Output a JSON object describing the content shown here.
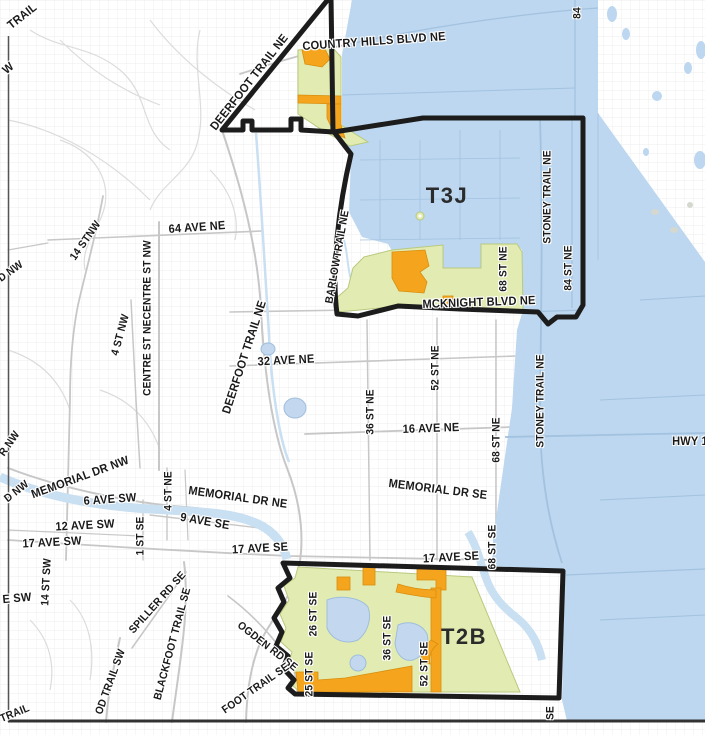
{
  "map": {
    "title": "Calgary zone map T3J / T2B",
    "zones": {
      "north_zone": "T3J",
      "south_zone": "T2B"
    },
    "colors": {
      "blue_region": "#BCD7EF",
      "zone_green": "#E2ECB2",
      "zone_green_edge": "#B9C97E",
      "orange": "#F5A51D",
      "orange_edge": "#D78E10",
      "boundary": "#1C1C1C",
      "river": "#C9DFF2",
      "pond": "#C3D8EE",
      "pond_edge": "#9FBEDC",
      "road_gray": "#C7C7C7",
      "road_light": "#DCDCDC",
      "road_blue": "#A3C2E0",
      "grid": "#E9E9E9",
      "label": "#1A1A1A",
      "frame": "#333333"
    },
    "labels": [
      {
        "t": "TRAIL",
        "x": 22,
        "y": 16,
        "r": -38,
        "s": 12
      },
      {
        "t": "W",
        "x": 8,
        "y": 68,
        "r": -40,
        "s": 12
      },
      {
        "t": "COUNTRY HILLS BLVD NE",
        "x": 374,
        "y": 41,
        "r": -4,
        "s": 12
      },
      {
        "t": "DEERFOOT TRAIL NE",
        "x": 249,
        "y": 82,
        "r": -52,
        "s": 12
      },
      {
        "t": "84",
        "x": 578,
        "y": 13,
        "r": -90,
        "s": 11
      },
      {
        "t": "T3J",
        "x": 447,
        "y": 196,
        "r": 0,
        "s": 22,
        "z": true
      },
      {
        "t": "STONEY TRAIL NE",
        "x": 548,
        "y": 197,
        "r": -90,
        "s": 11
      },
      {
        "t": "84 ST NE",
        "x": 569,
        "y": 268,
        "r": -90,
        "s": 11
      },
      {
        "t": "68 ST NE",
        "x": 504,
        "y": 269,
        "r": -90,
        "s": 11
      },
      {
        "t": "MCKNIGHT BLVD NE",
        "x": 479,
        "y": 302,
        "r": -2,
        "s": 12
      },
      {
        "t": "BARLOWTRAIL NE",
        "x": 338,
        "y": 257,
        "r": -80,
        "s": 11
      },
      {
        "t": "64 AVE NE",
        "x": 197,
        "y": 227,
        "r": -4,
        "s": 12
      },
      {
        "t": "14 STNW",
        "x": 86,
        "y": 241,
        "r": -55,
        "s": 11
      },
      {
        "t": "CENTRE ST NECENTRE ST NW",
        "x": 148,
        "y": 318,
        "r": -90,
        "s": 11
      },
      {
        "t": "4 ST NW",
        "x": 121,
        "y": 335,
        "r": -75,
        "s": 11
      },
      {
        "t": "DEERFOOT TRAIL NE",
        "x": 244,
        "y": 357,
        "r": -72,
        "s": 12
      },
      {
        "t": "32 AVE NE",
        "x": 286,
        "y": 360,
        "r": -3,
        "s": 12
      },
      {
        "t": "52 ST NE",
        "x": 436,
        "y": 368,
        "r": -90,
        "s": 11
      },
      {
        "t": "36 ST NE",
        "x": 371,
        "y": 412,
        "r": -90,
        "s": 11
      },
      {
        "t": "16 AVE NE",
        "x": 431,
        "y": 428,
        "r": -2,
        "s": 12
      },
      {
        "t": "68 ST NE",
        "x": 497,
        "y": 440,
        "r": -90,
        "s": 11
      },
      {
        "t": "STONEY TRAIL NE",
        "x": 541,
        "y": 401,
        "r": -90,
        "s": 11
      },
      {
        "t": "HWY 1",
        "x": 690,
        "y": 441,
        "r": 0,
        "s": 12
      },
      {
        "t": "MEMORIAL DR NW",
        "x": 80,
        "y": 477,
        "r": -20,
        "s": 12
      },
      {
        "t": "MEMORIAL DR NE",
        "x": 238,
        "y": 497,
        "r": 8,
        "s": 12
      },
      {
        "t": "6 AVE SW",
        "x": 110,
        "y": 499,
        "r": -4,
        "s": 12
      },
      {
        "t": "4 ST NE",
        "x": 169,
        "y": 491,
        "r": -90,
        "s": 11
      },
      {
        "t": "9 AVE SE",
        "x": 205,
        "y": 521,
        "r": 10,
        "s": 12
      },
      {
        "t": "12 AVE SW",
        "x": 85,
        "y": 525,
        "r": -3,
        "s": 12
      },
      {
        "t": "17 AVE SW",
        "x": 52,
        "y": 542,
        "r": -3,
        "s": 12
      },
      {
        "t": "1 ST SE",
        "x": 141,
        "y": 536,
        "r": -90,
        "s": 11
      },
      {
        "t": "17 AVE SE",
        "x": 260,
        "y": 548,
        "r": -3,
        "s": 12
      },
      {
        "t": "MEMORIAL DR SE",
        "x": 438,
        "y": 489,
        "r": 7,
        "s": 12
      },
      {
        "t": "17 AVE SE",
        "x": 451,
        "y": 557,
        "r": -3,
        "s": 12
      },
      {
        "t": "68 ST SE",
        "x": 493,
        "y": 547,
        "r": -90,
        "s": 11
      },
      {
        "t": "26 ST SE",
        "x": 314,
        "y": 614,
        "r": -90,
        "s": 11
      },
      {
        "t": "25 ST SE",
        "x": 310,
        "y": 674,
        "r": -90,
        "s": 11
      },
      {
        "t": "36 ST SE",
        "x": 388,
        "y": 638,
        "r": -90,
        "s": 11
      },
      {
        "t": "52 ST SE",
        "x": 425,
        "y": 664,
        "r": -90,
        "s": 11
      },
      {
        "t": "T2B",
        "x": 464,
        "y": 637,
        "r": 0,
        "s": 22,
        "z": true
      },
      {
        "t": "OGDEN RD SE",
        "x": 267,
        "y": 647,
        "r": 38,
        "s": 11
      },
      {
        "t": "SPILLER RD SE",
        "x": 158,
        "y": 603,
        "r": -48,
        "s": 11
      },
      {
        "t": "BLACKFOOT TRAIL SE",
        "x": 173,
        "y": 644,
        "r": -75,
        "s": 11
      },
      {
        "t": "OD TRAIL SW",
        "x": 111,
        "y": 682,
        "r": -70,
        "s": 11
      },
      {
        "t": "FOOT TRAIL SE",
        "x": 256,
        "y": 689,
        "r": -35,
        "s": 11
      },
      {
        "t": "14 ST SW",
        "x": 47,
        "y": 582,
        "r": -87,
        "s": 11
      },
      {
        "t": "E SW",
        "x": 17,
        "y": 598,
        "r": -5,
        "s": 12
      },
      {
        "t": "TRAIL",
        "x": 15,
        "y": 714,
        "r": -22,
        "s": 11
      },
      {
        "t": "D NW",
        "x": 11,
        "y": 272,
        "r": -35,
        "s": 11
      },
      {
        "t": "R NW",
        "x": 10,
        "y": 444,
        "r": -55,
        "s": 11
      },
      {
        "t": "D NW",
        "x": 17,
        "y": 492,
        "r": -38,
        "s": 11
      },
      {
        "t": "SE",
        "x": 551,
        "y": 713,
        "r": -90,
        "s": 11
      }
    ]
  }
}
